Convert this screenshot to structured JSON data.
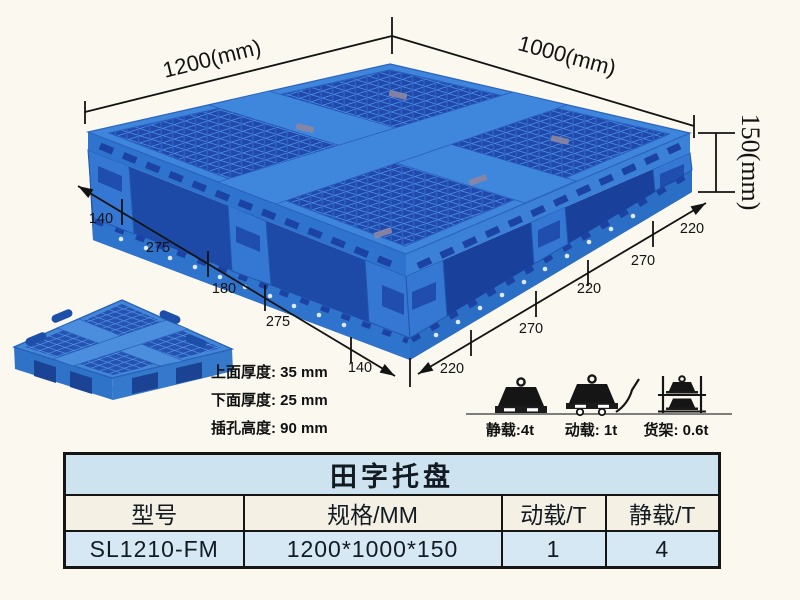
{
  "page": {
    "background": "#faf8ef"
  },
  "diagram": {
    "dimensions": {
      "length": "1200(mm)",
      "width": "1000(mm)",
      "height": "150(mm)",
      "bottom_left_chain": [
        "140",
        "275",
        "180",
        "275",
        "140"
      ],
      "bottom_right_chain": [
        "220",
        "270",
        "220",
        "270",
        "220"
      ]
    },
    "thickness_notes": [
      "上面厚度: 35 mm",
      "下面厚度: 25 mm",
      "插孔高度: 90 mm"
    ],
    "load_ratings": [
      {
        "icon": "weight-on-pallet-icon",
        "label": "静载:4t"
      },
      {
        "icon": "weight-on-trolley-icon",
        "label": "动载: 1t"
      },
      {
        "icon": "weights-on-rack-icon",
        "label": "货架: 0.6t"
      }
    ]
  },
  "table": {
    "title": "田字托盘",
    "headers": [
      "型号",
      "规格/MM",
      "动载/T",
      "静载/T"
    ],
    "rows": [
      [
        "SL1210-FM",
        "1200*1000*150",
        "1",
        "4"
      ]
    ]
  },
  "colors": {
    "pallet_blue": "#3478d3",
    "pallet_rim_blue": "#3e86db",
    "pallet_dark_blue": "#1d4aa7",
    "pallet_hole_blue": "#2149ac",
    "table_title_bg": "#cde3f0",
    "table_header_bg": "#f4f0e4",
    "table_row_bg": "#d5e8f4",
    "line_color": "#131313",
    "background": "#faf8ef"
  }
}
